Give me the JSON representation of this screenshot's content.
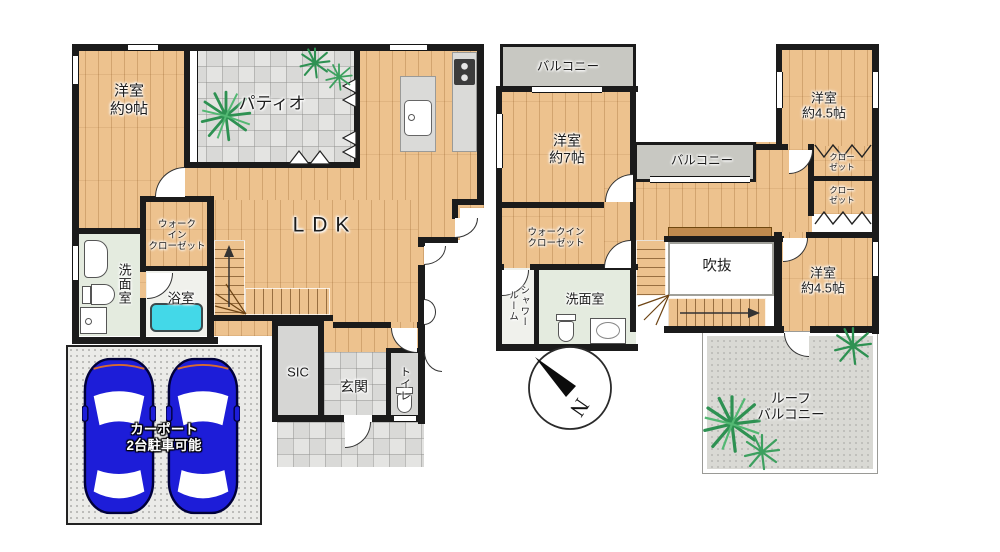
{
  "floor1": {
    "bedroom9": "洋室\n約9帖",
    "patio": "パティオ",
    "ldk": "LDK",
    "walkin_closet": "ウォーク\nイン\nクローゼット",
    "washroom": "洗面室",
    "bathroom": "浴室",
    "shoe_closet": "SIC",
    "entrance": "玄関",
    "toilet": "トイレ",
    "carport": "カーポート\n2台駐車可能"
  },
  "floor2": {
    "balcony_top": "バルコニー",
    "bedroom7": "洋室\n約7帖",
    "balcony_mid": "バルコニー",
    "bedroom45_ne": "洋室\n約4.5帖",
    "closet_upper": "クロー\nゼット",
    "closet_lower": "クロー\nゼット",
    "walkin_closet": "ウォークイン\nクローゼット",
    "shower_room": "シャワー\nルーム",
    "washroom": "洗面室",
    "atrium": "吹抜",
    "bedroom45_se": "洋室\n約4.5帖",
    "roof_balcony": "ルーフ\nバルコニー"
  },
  "compass": {
    "north_label": "N"
  },
  "colors": {
    "wood": "#edc28e",
    "wall": "#1b1b1b",
    "tile_gray": "#e0e0de",
    "balcony_gray": "#c8c8c2",
    "tub_cyan": "#43d8e8",
    "car_blue": "#1d1dd8",
    "plant_green": "#2e9152",
    "washroom_green": "#e4ebdf"
  }
}
